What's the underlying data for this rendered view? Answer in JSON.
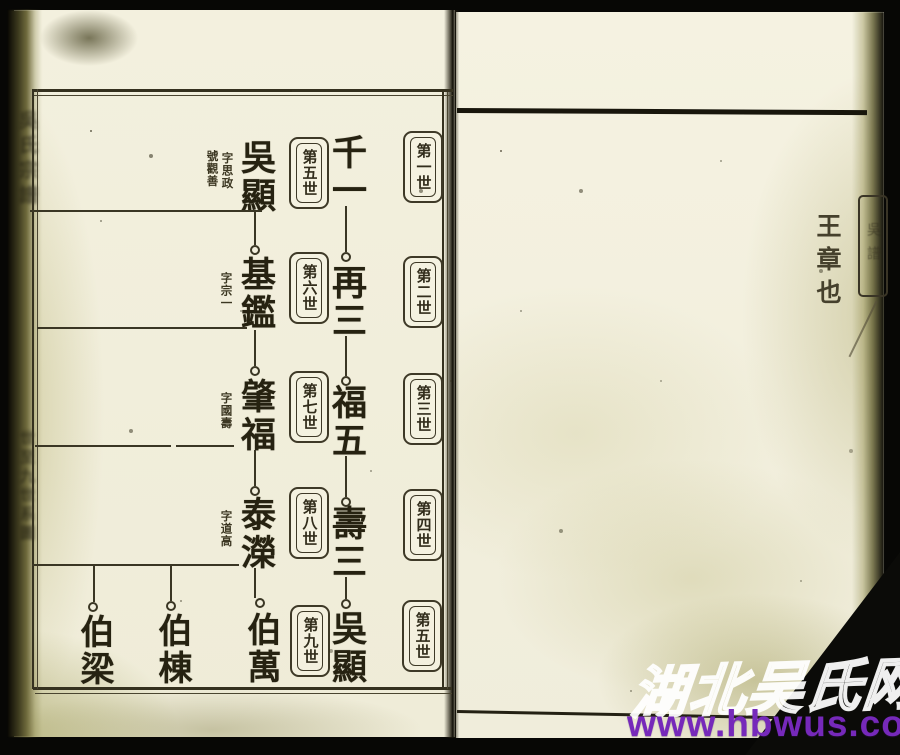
{
  "palette": {
    "background": "#070705",
    "paper": "#f2efdd",
    "ink": "#3a3624",
    "watermark_purple": "#7629ba",
    "watermark_white": "#ffffff"
  },
  "left_page": {
    "spine_fragment_top": "吳氏宗譜",
    "spine_fragment_bottom": "世至九世系圖",
    "col_right": {
      "labels": [
        "第一世",
        "第二世",
        "第三世",
        "第四世",
        "第五世"
      ],
      "names": [
        "千一",
        "再三",
        "福五",
        "壽三",
        "吳顯"
      ]
    },
    "col_left": {
      "labels": [
        "第五世",
        "第六世",
        "第七世",
        "第八世",
        "第九世"
      ],
      "names": [
        "吳顯",
        "基鑑",
        "肇福",
        "泰濚"
      ],
      "notes": {
        "wuxian_zi": "字思政",
        "wuxian_hao": "號觀善",
        "jijian_zi": "字宗一",
        "zhaofu_zi": "字國壽",
        "tairong_zi": "字道高"
      },
      "gen9": [
        "伯萬",
        "伯棟",
        "伯梁"
      ]
    }
  },
  "right_page": {
    "caption": "王章也",
    "edge_label_fragment": "吳譜"
  },
  "watermark": {
    "site_name": "湖北吴氏网",
    "url": "www.hbwus.com"
  }
}
